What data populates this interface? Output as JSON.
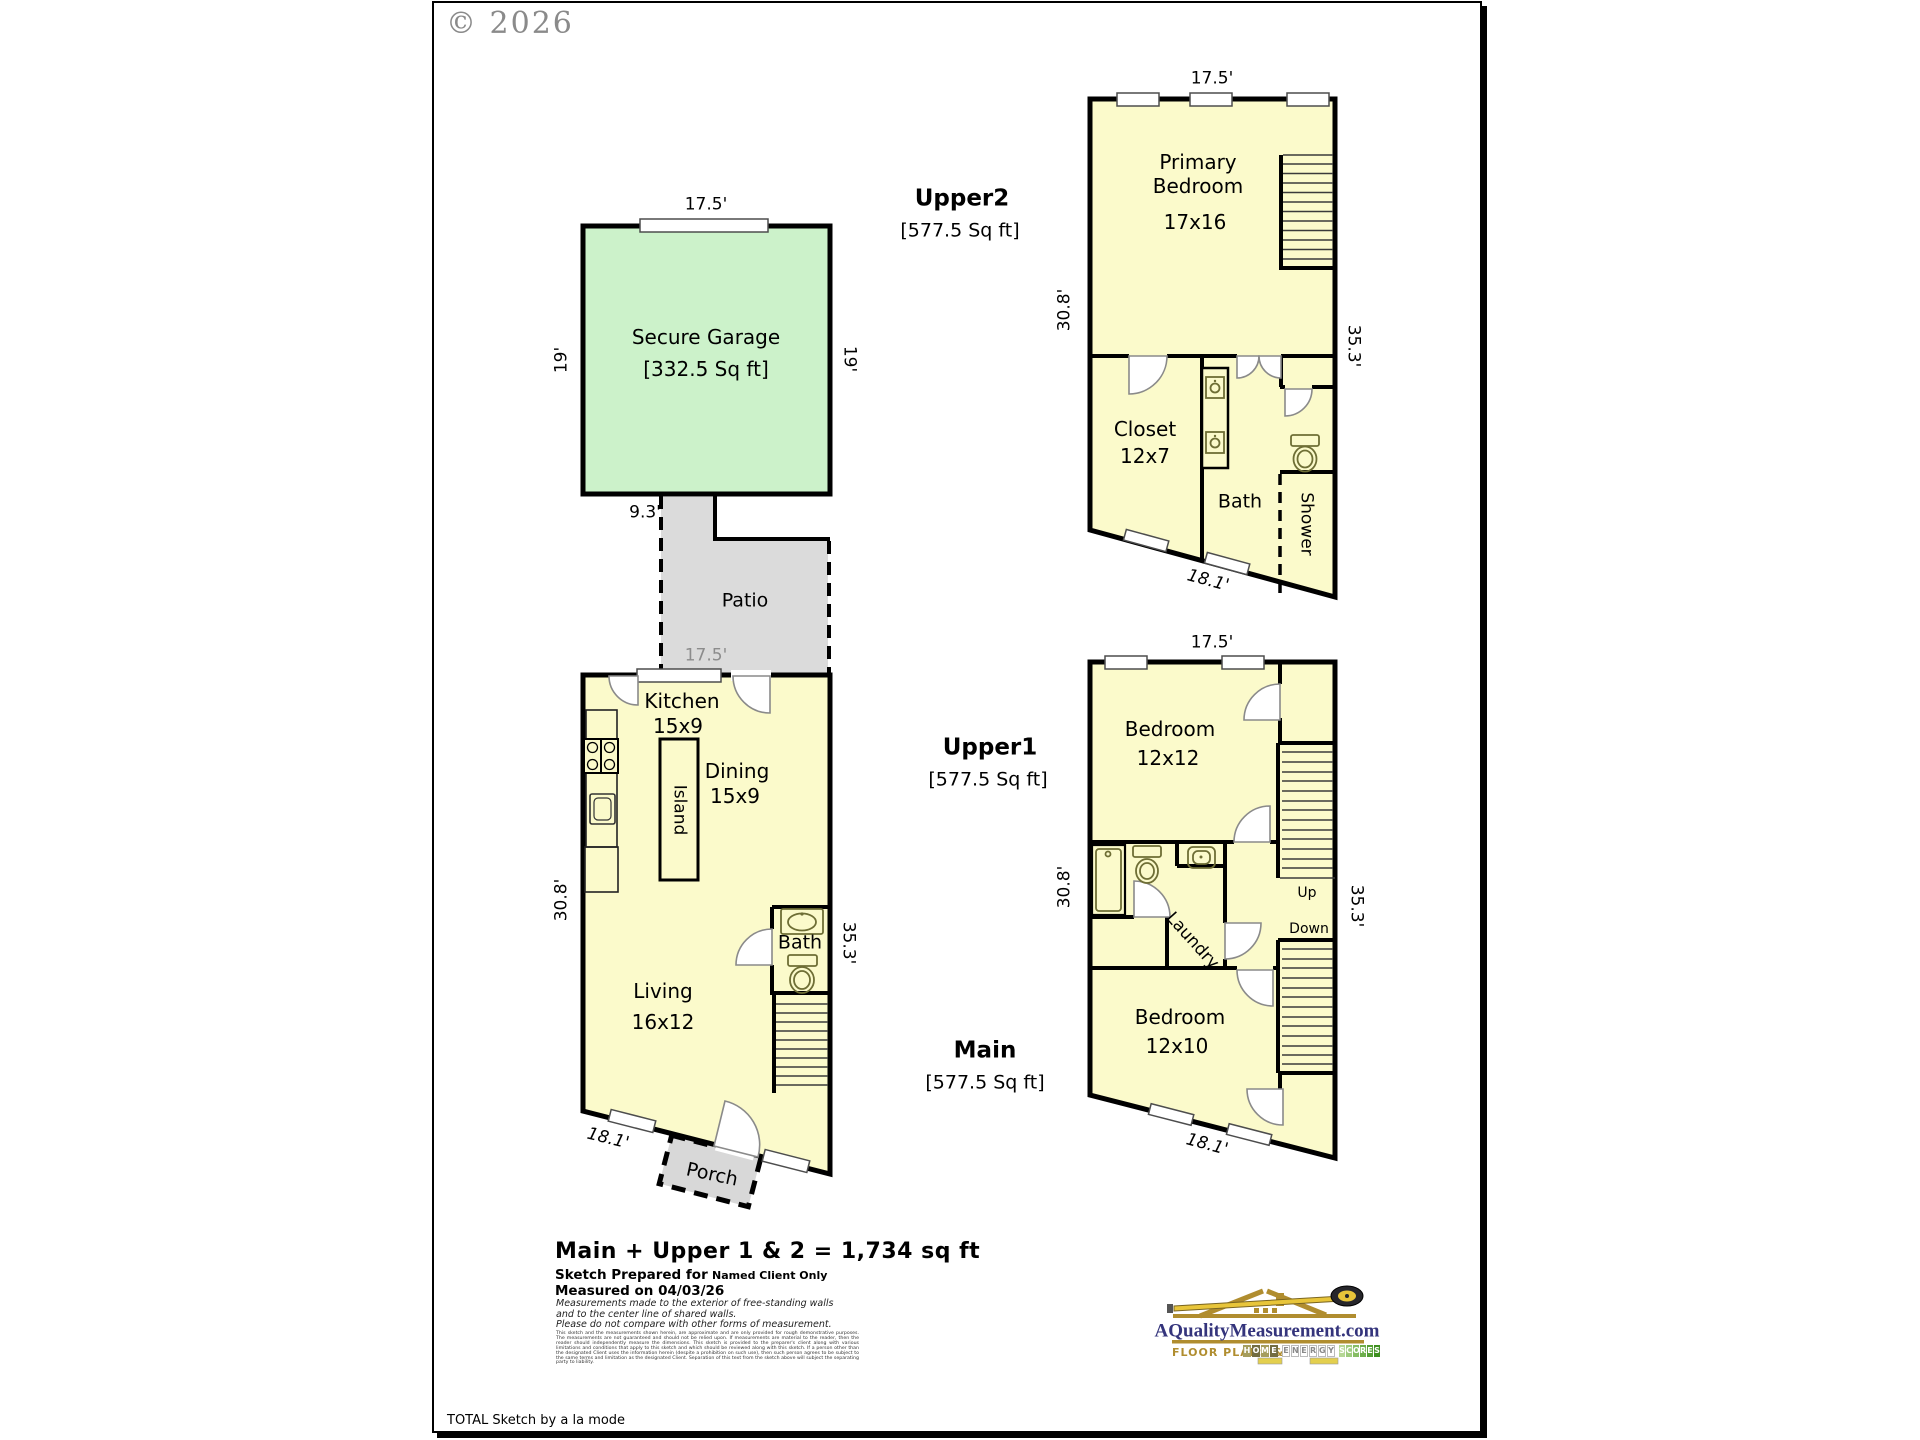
{
  "copyright": "© 2026",
  "garage": {
    "name": "Secure Garage",
    "sqft": "[332.5 Sq ft]",
    "width_top": "17.5'",
    "height_left": "19'",
    "height_right": "19'",
    "offset": "9.3'"
  },
  "patio": {
    "name": "Patio",
    "width_bottom": "17.5'"
  },
  "main": {
    "title": "Main",
    "sqft": "[577.5 Sq ft]",
    "kitchen": "Kitchen",
    "kitchen_size": "15x9",
    "island": "Island",
    "dining": "Dining",
    "dining_size": "15x9",
    "bath": "Bath",
    "living": "Living",
    "living_size": "16x12",
    "porch": "Porch",
    "height_left": "30.8'",
    "height_right": "35.3'",
    "width_bottom": "18.1'"
  },
  "upper1": {
    "title": "Upper1",
    "sqft": "[577.5 Sq ft]",
    "width_top": "17.5'",
    "bedroom1": "Bedroom",
    "bedroom1_size": "12x12",
    "bedroom2": "Bedroom",
    "bedroom2_size": "12x10",
    "laundry": "Laundry",
    "up": "Up",
    "down": "Down",
    "height_left": "30.8'",
    "height_right": "35.3'",
    "width_bottom": "18.1'"
  },
  "upper2": {
    "title": "Upper2",
    "sqft": "[577.5 Sq ft]",
    "width_top": "17.5'",
    "primary1": "Primary",
    "primary2": "Bedroom",
    "primary_size": "17x16",
    "closet": "Closet",
    "closet_size": "12x7",
    "bath": "Bath",
    "shower": "Shower",
    "height_left": "30.8'",
    "height_right": "35.3'",
    "width_bottom": "18.1'"
  },
  "summary": {
    "total": "Main + Upper 1 & 2 = 1,734 sq ft",
    "prepared_label": "Sketch Prepared for",
    "prepared_value": "Named Client Only",
    "measured": "Measured on 04/03/26",
    "note1": "Measurements made to the exterior of free-standing walls",
    "note2": "and to the center line of shared walls.",
    "note3": "Please do not compare with other forms of measurement.",
    "disclaimer": "This sketch and the measurements shown herein, are approximate and are only provided for rough demonstrative purposes.  The measurements are not guaranteed and should not be relied upon.  If measurements are material to the reader, then the reader should independently measure the dimensions.  This sketch is provided to the preparer's client along with various limitations and conditions that apply to this sketch and which should be reviewed along with this sketch.  If a person other than the designated Client uses the information herein (despite a prohibition on such use), then such person agrees to be subject to the same terms and limitation as the designated Client.  Separation of this text from the sketch above will subject the separating party to liability."
  },
  "logo": {
    "url": "AQualityMeasurement.com",
    "tagline": "Floor Plans &",
    "home": [
      "H",
      "O",
      "M",
      "E"
    ],
    "energy": [
      "E",
      "N",
      "E",
      "R",
      "G",
      "Y"
    ],
    "scores": [
      "S",
      "C",
      "O",
      "R",
      "E",
      "S"
    ],
    "colors": {
      "gold": "#b08d2f",
      "navy": "#34347c",
      "green": "#3d8f1f"
    }
  },
  "footer": {
    "brand": "TOTAL Sketch by a la mode"
  },
  "colors": {
    "room_yellow": "#FBFACB",
    "garage_green": "#CCF2CA",
    "patio_gray": "#DBDBDB",
    "wall": "#000000"
  }
}
